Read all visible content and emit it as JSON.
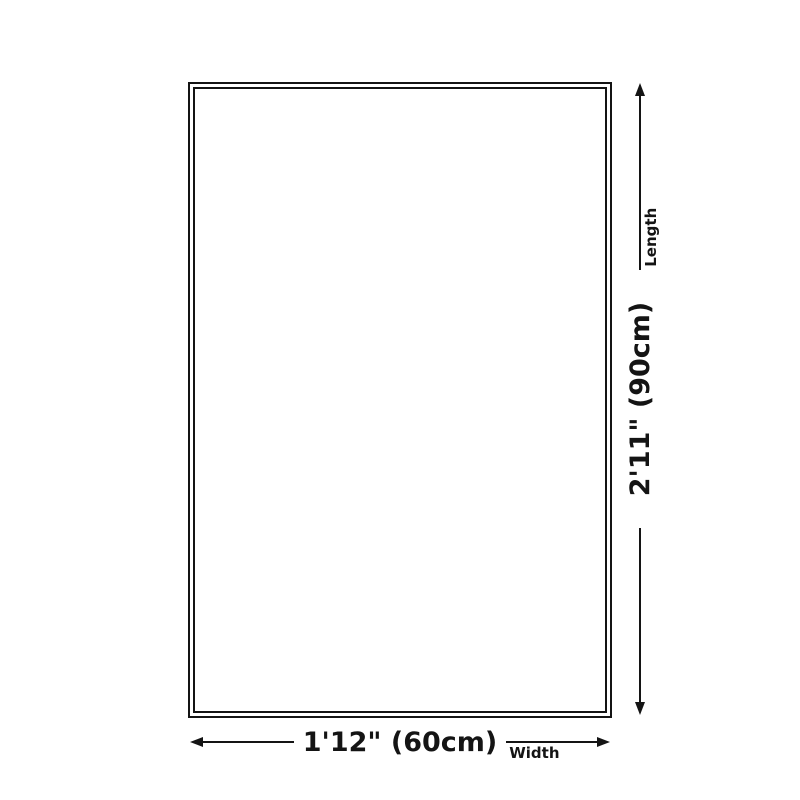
{
  "diagram": {
    "background_color": "#ffffff",
    "stroke_color": "#141414",
    "shape": "rectangle-double-border",
    "length_dimension": {
      "value": "2'11\" (90cm)",
      "label": "Length",
      "orientation": "vertical"
    },
    "width_dimension": {
      "value": "1'12\" (60cm)",
      "label": "Width",
      "orientation": "horizontal"
    }
  }
}
